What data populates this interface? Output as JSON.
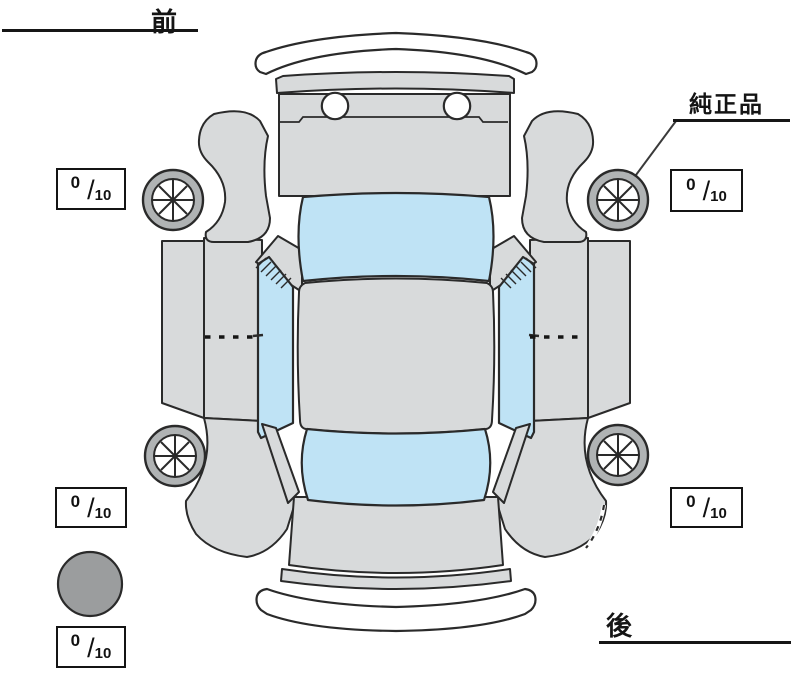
{
  "diagram": {
    "type": "vehicle-top-view-condition-diagram",
    "orientation": {
      "front_label": "前",
      "rear_label": "後"
    },
    "callout": {
      "label": "純正品",
      "target": "front-right-wheel"
    },
    "fraction_slash": "/",
    "tread_depth_boxes": [
      {
        "position": "front-left",
        "value": "0",
        "out_of": "10"
      },
      {
        "position": "front-right",
        "value": "0",
        "out_of": "10"
      },
      {
        "position": "rear-left",
        "value": "0",
        "out_of": "10"
      },
      {
        "position": "rear-right",
        "value": "0",
        "out_of": "10"
      },
      {
        "position": "spare-bottom-left",
        "value": "0",
        "out_of": "10"
      }
    ],
    "icons": {
      "wheel": "eight-spoke-wheel-icon",
      "spare_marker": "filled-gray-circle"
    },
    "colors": {
      "body": "#d8dadb",
      "glass": "#bfe3f5",
      "tire": "#b0b3b4",
      "circle": "#9b9d9e",
      "outline": "#2a2a2a",
      "ink": "#111111"
    }
  }
}
